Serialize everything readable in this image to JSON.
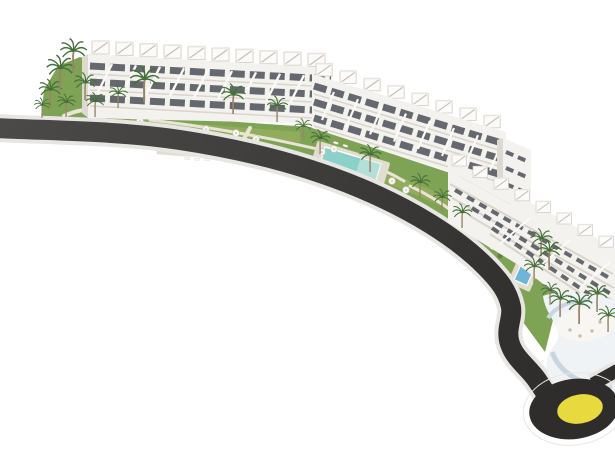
{
  "scene": {
    "type": "architectural-render",
    "description": "Aerial 3D rendering of a modern white apartment complex with terraced roofs and rooftop pergolas, landscaped gardens, three swimming pools with sun loungers and parasols, palm trees, a curving access road and a roundabout with a yellow centre island"
  },
  "colors": {
    "background": "#ffffff",
    "asphalt": "#413f3e",
    "asphalt_dark": "#2e2d2b",
    "curb": "#e8e6e2",
    "grass": "#7fa355",
    "grass_light": "#a2b565",
    "path": "#e9e4d6",
    "building": "#f4f2ee",
    "building_shade": "#ddd9d1",
    "window": "#4b5057",
    "deck": "#e2ddd1",
    "pool_blue": "#a4c7ca",
    "pool_turquoise": "#8bd0c9",
    "pool_deep": "#6fb5d8",
    "palm_trunk": "#9a8468",
    "palm_leaf": "#44703a",
    "roundabout_yellow": "#e8d93f",
    "beach_wall": "#c9d6e0",
    "beach_floor": "#f0f3f5"
  }
}
